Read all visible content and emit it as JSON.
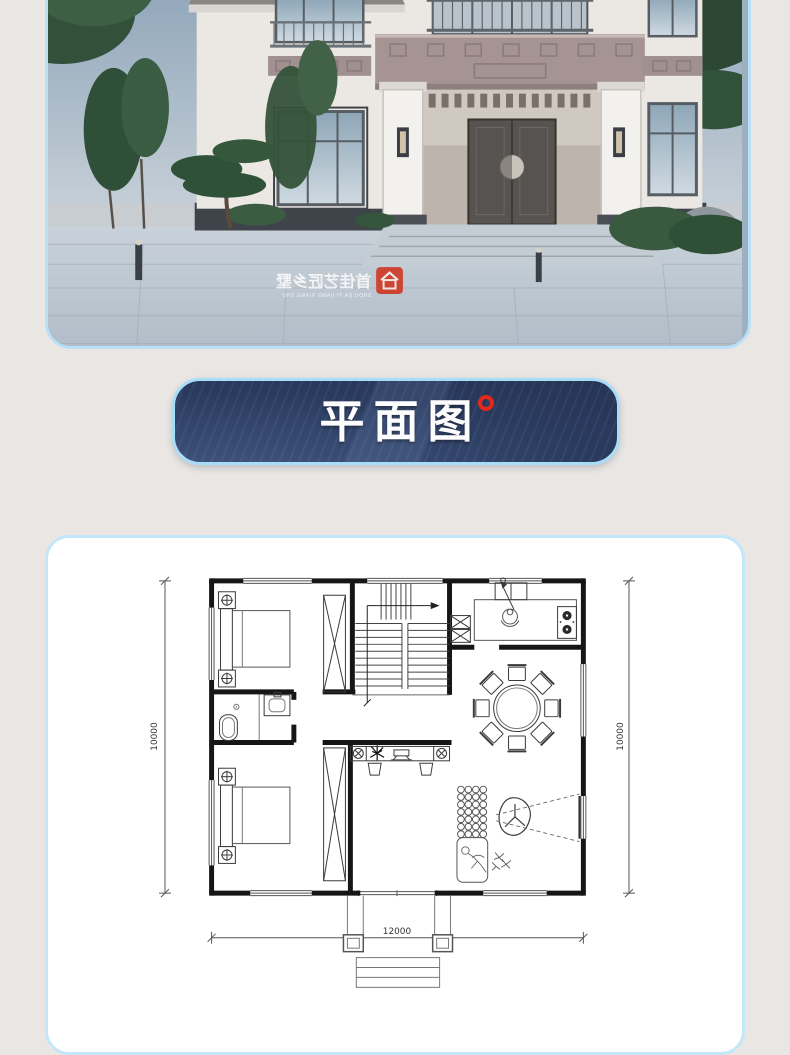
{
  "page": {
    "background": "#e9e6e3"
  },
  "hero": {
    "watermark_cn": "首佳艺匠乡墅",
    "watermark_en": "SHOU JIA YI JIANG XIANG SHU"
  },
  "banner": {
    "label": "平面图"
  },
  "floorplan": {
    "dim_left": "10000",
    "dim_right": "10000",
    "dim_bottom": "12000"
  },
  "colors": {
    "banner_bg": "#2c3b5e",
    "card_border": "#b9e0f6",
    "accent_red": "#e6271a",
    "wall_line": "#161616"
  }
}
